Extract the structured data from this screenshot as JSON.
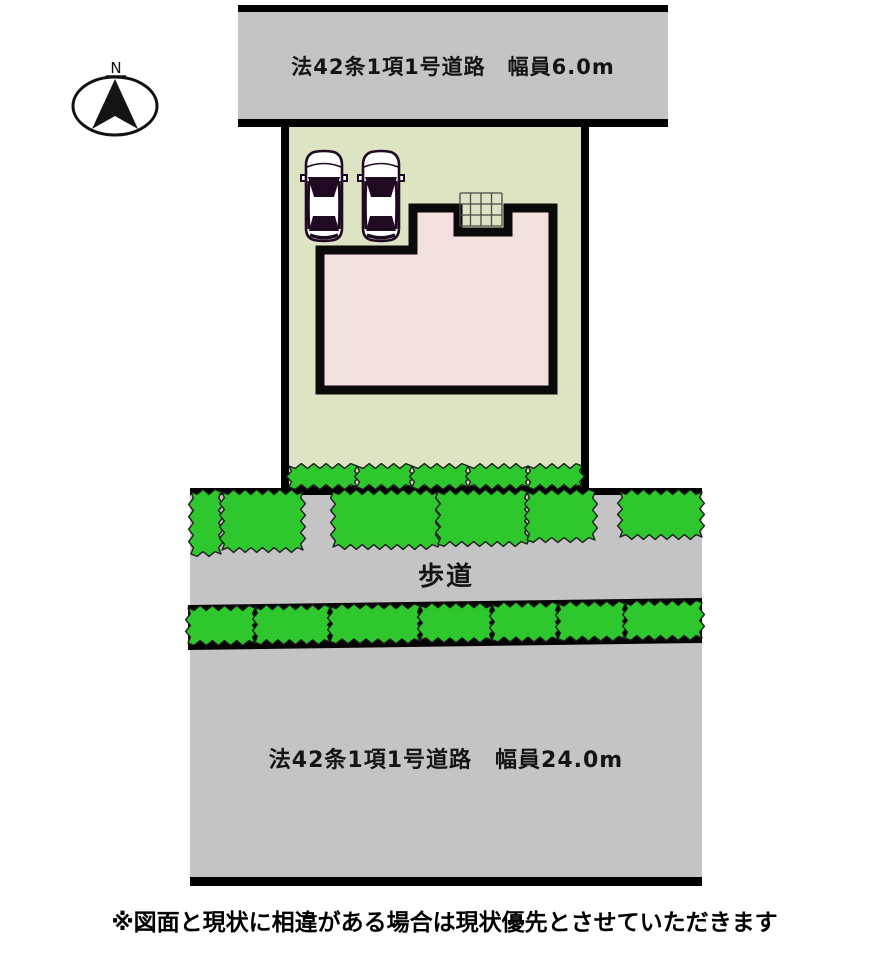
{
  "compass": {
    "label": "N"
  },
  "roads": {
    "top": {
      "label": "法42条1項1号道路　幅員6.0m"
    },
    "bottom": {
      "label": "法42条1項1号道路　幅員24.0m"
    }
  },
  "sidewalk": {
    "label": "歩道"
  },
  "disclaimer": "※図面と現状に相違がある場合は現状優先とさせていただきます",
  "site": {
    "lot": "宅地",
    "house": "建物",
    "parking_cars": 2
  },
  "colors": {
    "road_gray": "#c4c4c4",
    "lot_green": "#dde4c3",
    "house_pink": "#f4dfdf",
    "hedge_green": "#2ec82e",
    "outline_black": "#0a0a0a",
    "car_dark": "#200a22"
  }
}
